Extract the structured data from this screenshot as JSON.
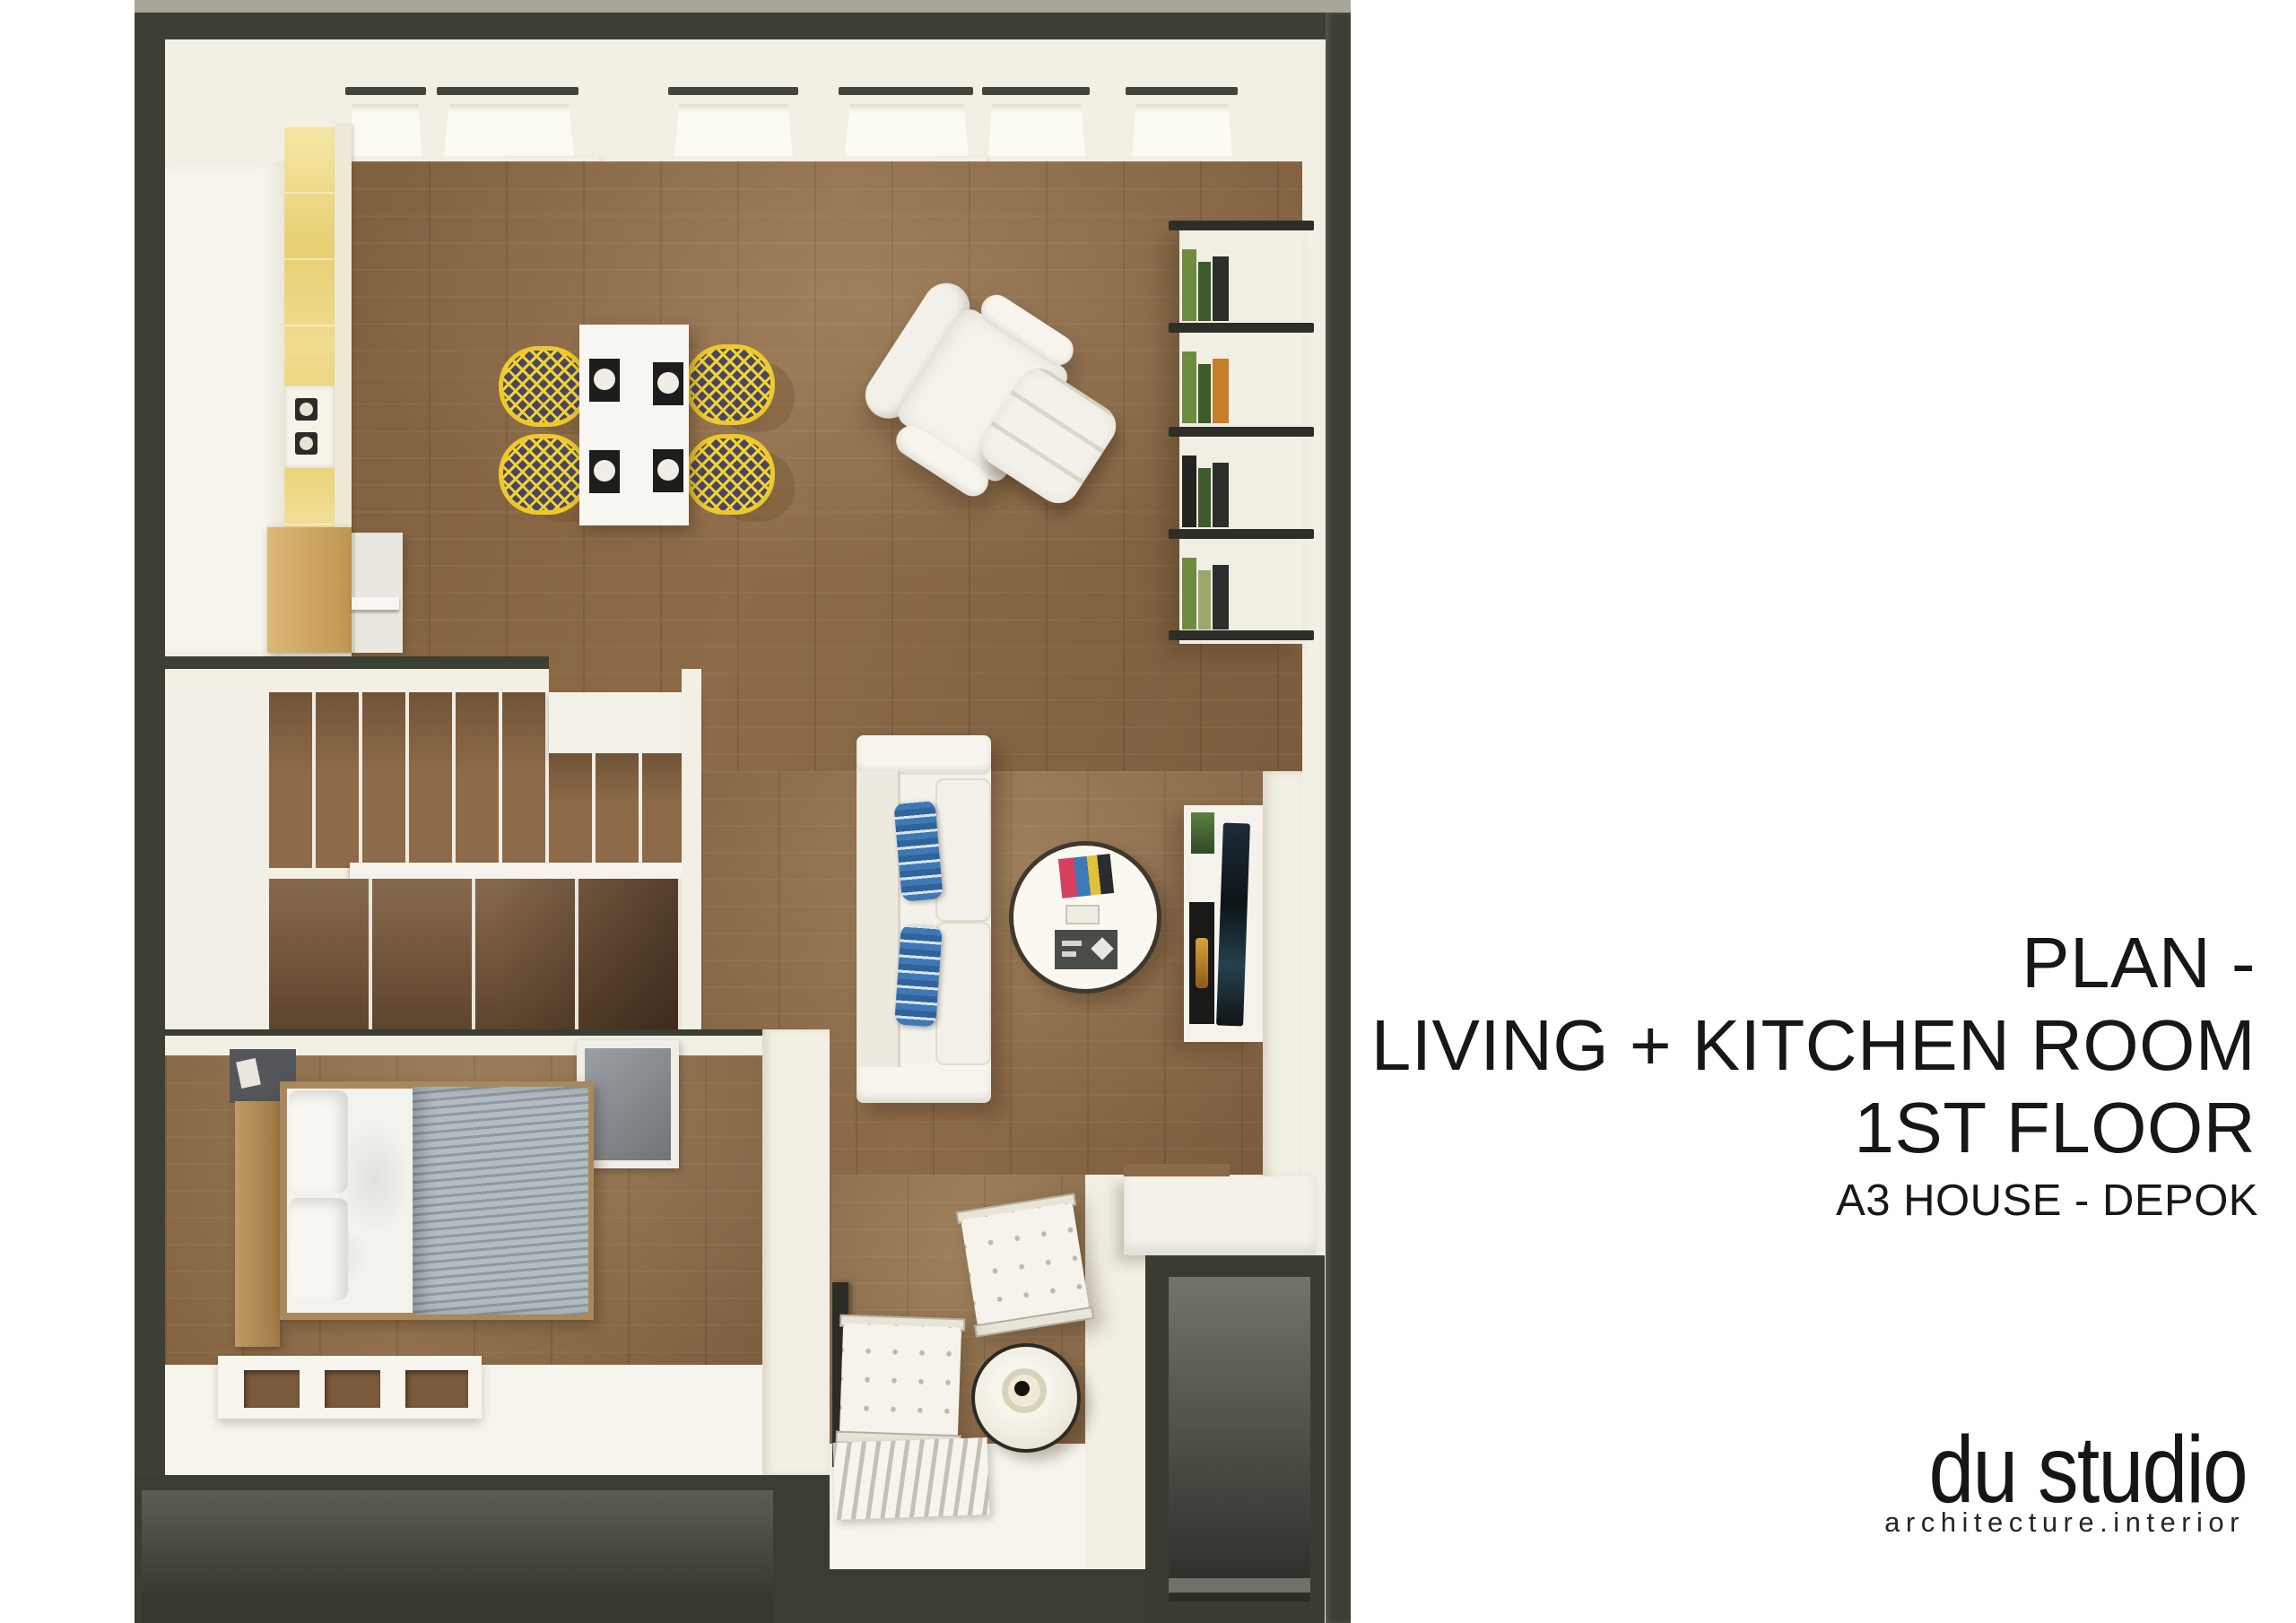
{
  "board": {
    "title_line1": "PLAN -",
    "title_line2": "LIVING + KITCHEN ROOM",
    "title_line3": "1ST FLOOR",
    "subtitle": "A3 HOUSE - DEPOK",
    "logo_name": "du studio",
    "logo_tagline": "architecture.interior"
  },
  "colors": {
    "page-bg": "#ffffff",
    "text-dark": "#171717",
    "wall-dark": "#3d3e34",
    "wall-light-top": "#a9a699",
    "cream": "#f2efe4",
    "white-soft": "#f6f4ec",
    "wood": "#8d6b48",
    "wood-dark": "#6a4c31",
    "kitchen-yellow": "#ead377",
    "chair-yellow": "#f2d32f",
    "pillow-blue": "#3f78b5",
    "duvet-gray": "#9aa4ab",
    "terrace-gray": "#70726a"
  }
}
